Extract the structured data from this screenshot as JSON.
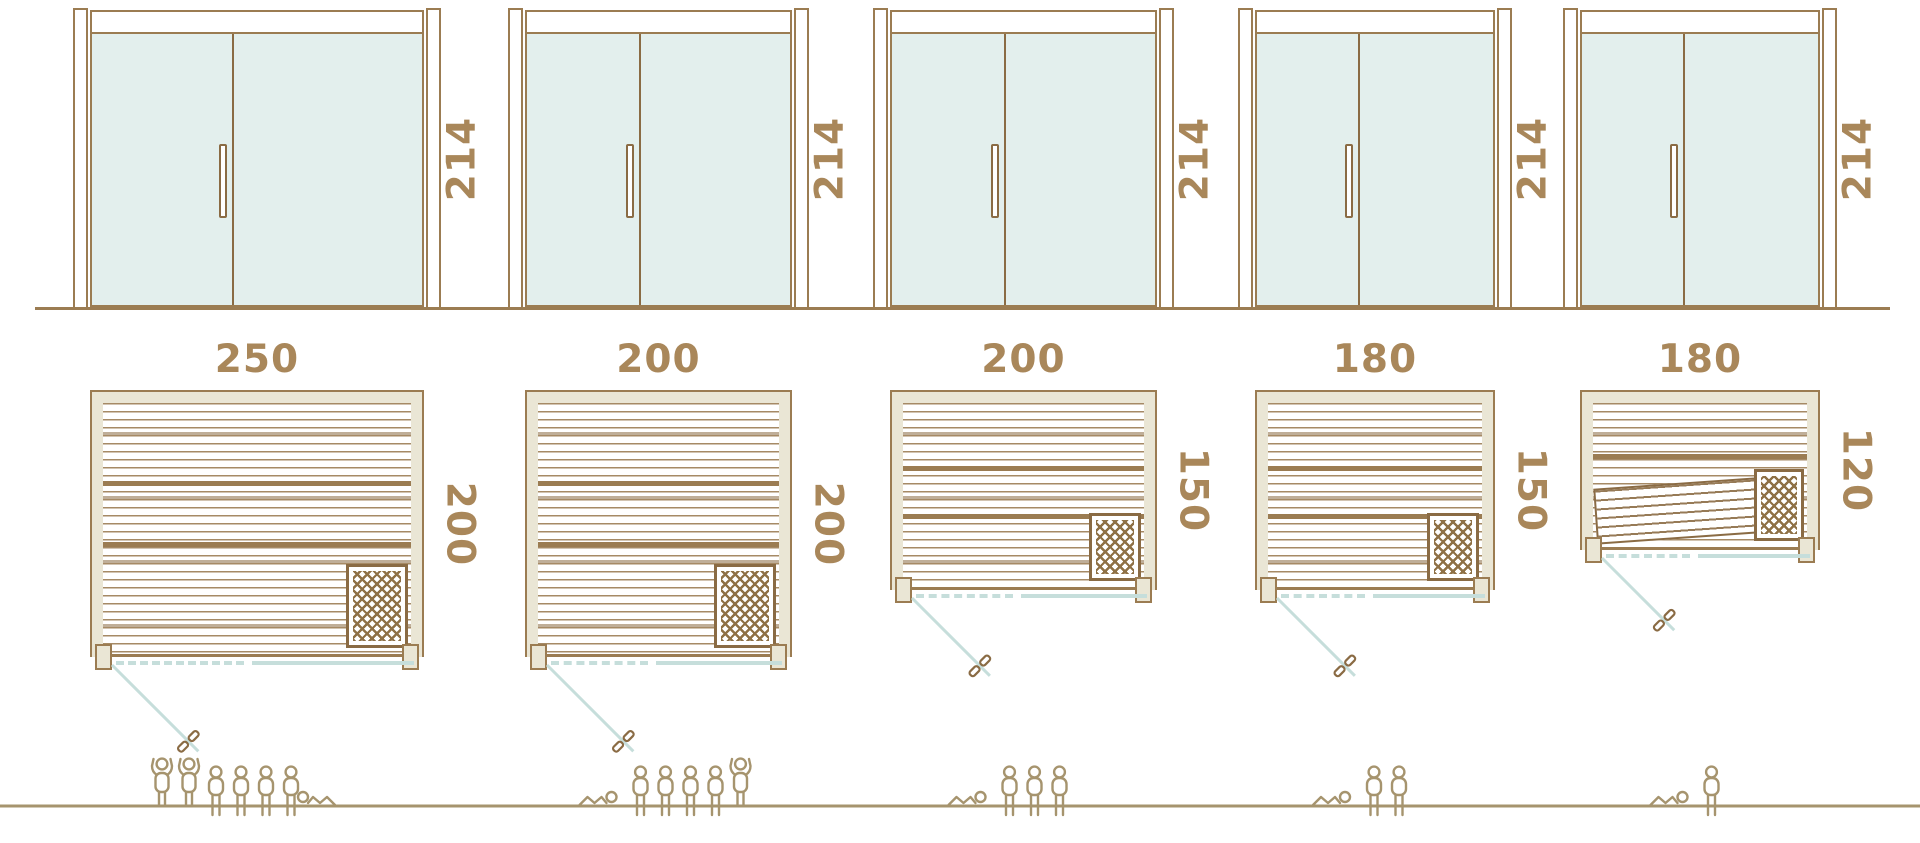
{
  "diagram": {
    "title": "sauna-size-comparison",
    "columns": [
      {
        "door": {
          "height_label": "214"
        },
        "plan": {
          "width_label": "250",
          "depth_label": "200",
          "heater": true,
          "tilted_bench": false
        },
        "people": [
          "standing",
          "standing",
          "seated",
          "seated",
          "seated",
          "seated",
          "reclining"
        ]
      },
      {
        "door": {
          "height_label": "214"
        },
        "plan": {
          "width_label": "200",
          "depth_label": "200",
          "heater": true,
          "tilted_bench": false
        },
        "people": [
          "reclining",
          "seated",
          "seated",
          "seated",
          "seated",
          "standing"
        ]
      },
      {
        "door": {
          "height_label": "214"
        },
        "plan": {
          "width_label": "200",
          "depth_label": "150",
          "heater": true,
          "tilted_bench": false
        },
        "people": [
          "reclining",
          "seated",
          "seated",
          "seated"
        ]
      },
      {
        "door": {
          "height_label": "214"
        },
        "plan": {
          "width_label": "180",
          "depth_label": "150",
          "heater": true,
          "tilted_bench": false
        },
        "people": [
          "reclining",
          "seated",
          "seated"
        ]
      },
      {
        "door": {
          "height_label": "214"
        },
        "plan": {
          "width_label": "180",
          "depth_label": "120",
          "heater": true,
          "tilted_bench": true
        },
        "people": [
          "reclining",
          "seated"
        ]
      }
    ],
    "colors": {
      "outline_brown": "#9b7c52",
      "dark_brown": "#8a6b44",
      "label_brown": "#a9875a",
      "glass_teal": "#e3efed",
      "wall_cream": "#eae6d5",
      "swing_teal": "#c6dedb",
      "people_tan": "#a6946e"
    }
  }
}
